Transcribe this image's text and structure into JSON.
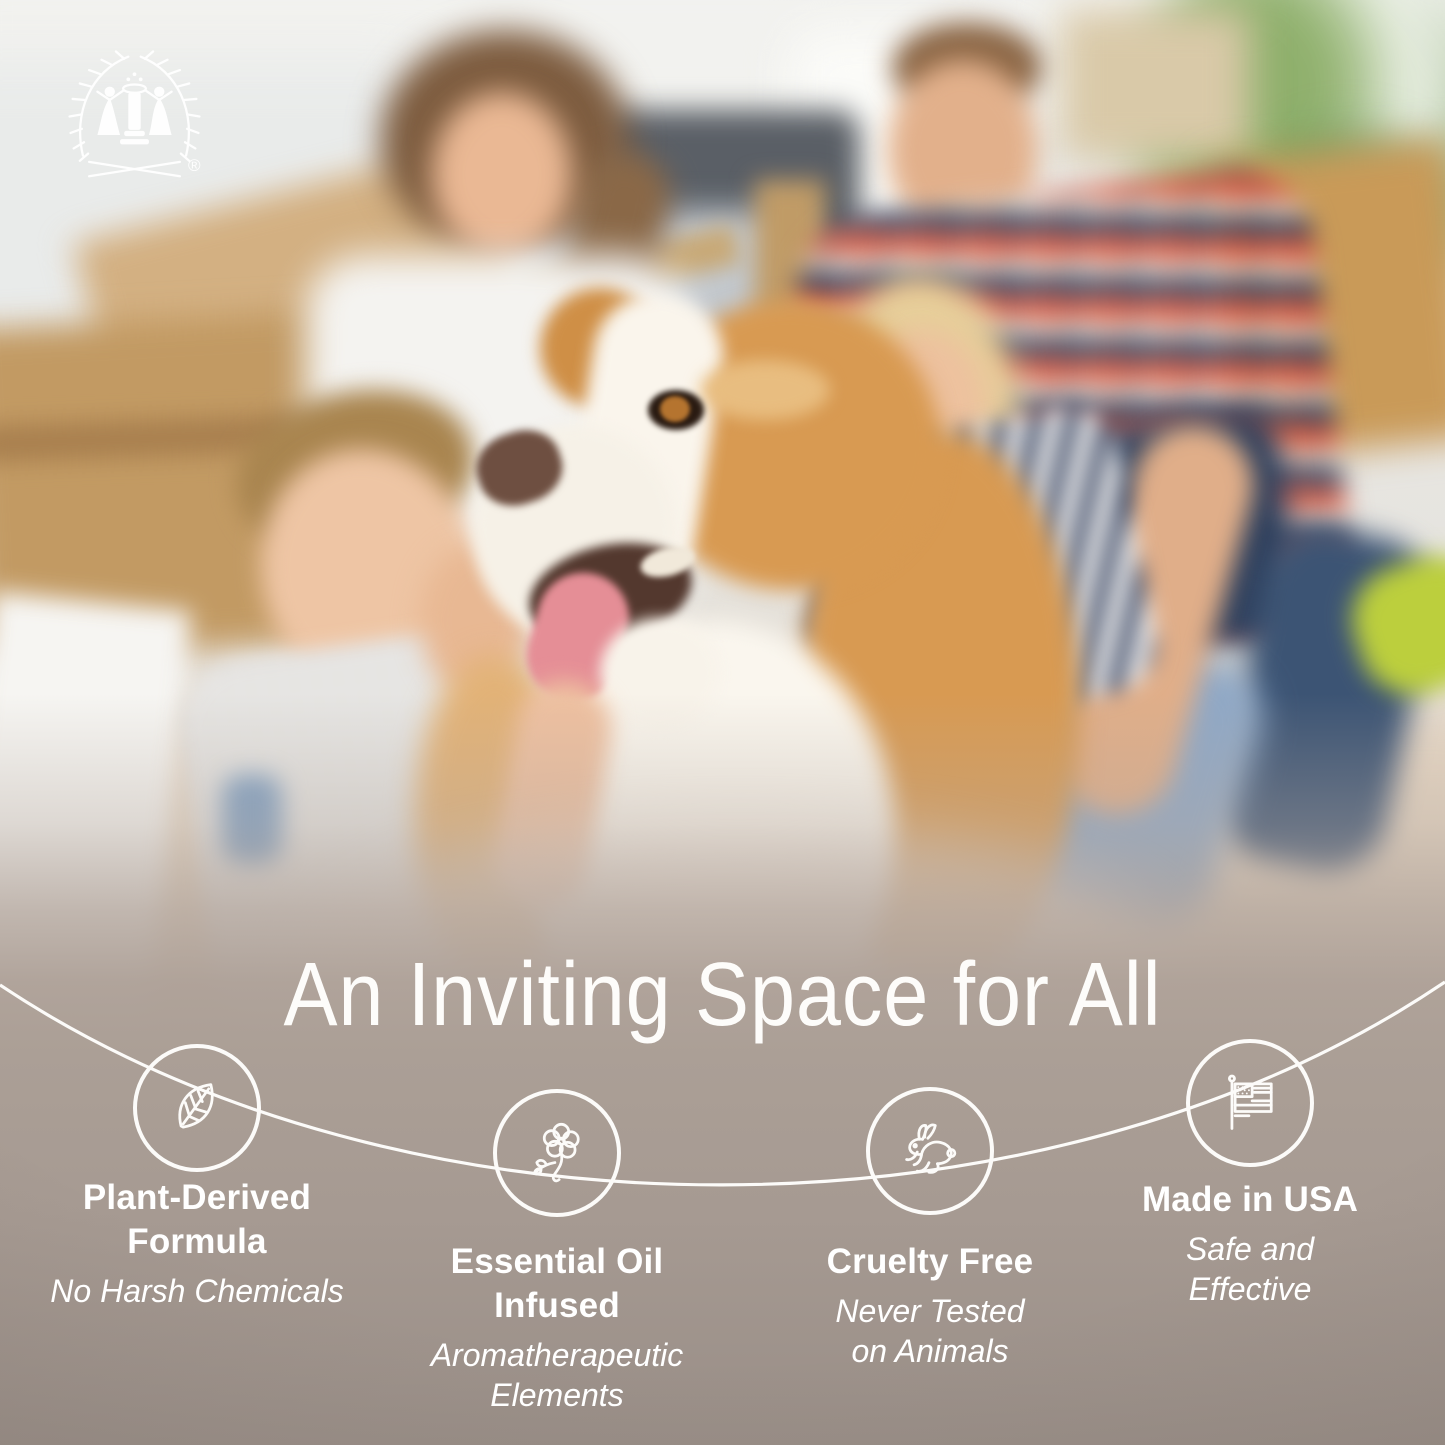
{
  "brand": {
    "logo": "laurel-wreath-figures-emblem",
    "registered_mark": "®"
  },
  "headline": "An Inviting Space for All",
  "features": [
    {
      "icon": "leaf-icon",
      "title": "Plant-Derived\nFormula",
      "subtitle": "No Harsh Chemicals"
    },
    {
      "icon": "flower-icon",
      "title": "Essential Oil\nInfused",
      "subtitle": "Aromatherapeutic\nElements"
    },
    {
      "icon": "rabbit-icon",
      "title": "Cruelty Free",
      "subtitle": "Never Tested\non Animals"
    },
    {
      "icon": "usa-flag-icon",
      "title": "Made in USA",
      "subtitle": "Safe and\nEffective"
    }
  ],
  "colors": {
    "text": "#ffffff",
    "line_and_icons": "#fbfaf8",
    "background_taupe": "#a69a92",
    "background_bottom": "#998e87"
  }
}
